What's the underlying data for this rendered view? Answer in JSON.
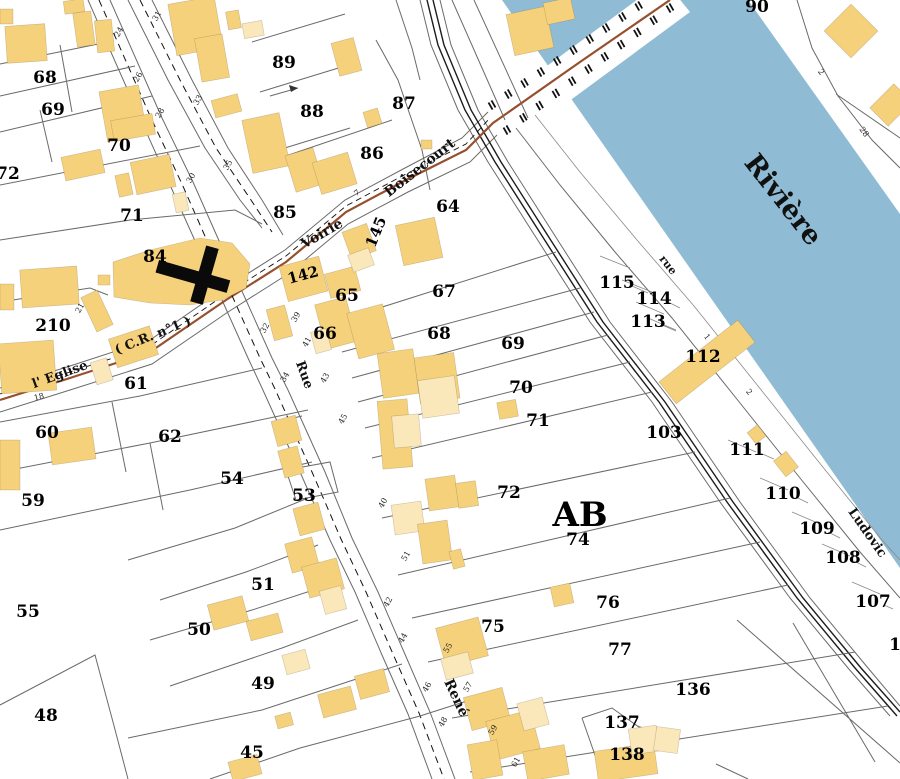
{
  "map": {
    "region_code": "AB",
    "river_name": "Rivière",
    "colors": {
      "river": "#8fbcd4",
      "building": "#f6d17c",
      "building_light": "#fae8bb",
      "route_brown": "#96502d",
      "boundary_gray": "#6a6a6a",
      "road_dark": "#1c1c1c",
      "background": "#ffffff",
      "text": "#000000"
    },
    "parcel_labels": [
      {
        "t": "90",
        "x": 757,
        "y": 7
      },
      {
        "t": "68",
        "x": 45,
        "y": 78
      },
      {
        "t": "69",
        "x": 53,
        "y": 110
      },
      {
        "t": "70",
        "x": 119,
        "y": 146
      },
      {
        "t": "72",
        "x": 8,
        "y": 174
      },
      {
        "t": "71",
        "x": 132,
        "y": 216
      },
      {
        "t": "89",
        "x": 284,
        "y": 63
      },
      {
        "t": "88",
        "x": 312,
        "y": 112
      },
      {
        "t": "87",
        "x": 404,
        "y": 104
      },
      {
        "t": "86",
        "x": 372,
        "y": 154
      },
      {
        "t": "85",
        "x": 285,
        "y": 213
      },
      {
        "t": "64",
        "x": 448,
        "y": 207
      },
      {
        "t": "84",
        "x": 155,
        "y": 257
      },
      {
        "t": "210",
        "x": 53,
        "y": 326
      },
      {
        "t": "61",
        "x": 136,
        "y": 384
      },
      {
        "t": "60",
        "x": 47,
        "y": 433
      },
      {
        "t": "62",
        "x": 170,
        "y": 437
      },
      {
        "t": "54",
        "x": 232,
        "y": 479
      },
      {
        "t": "59",
        "x": 33,
        "y": 501
      },
      {
        "t": "53",
        "x": 304,
        "y": 496
      },
      {
        "t": "55",
        "x": 28,
        "y": 612
      },
      {
        "t": "51",
        "x": 263,
        "y": 585
      },
      {
        "t": "50",
        "x": 199,
        "y": 630
      },
      {
        "t": "49",
        "x": 263,
        "y": 684
      },
      {
        "t": "45",
        "x": 252,
        "y": 753
      },
      {
        "t": "48",
        "x": 46,
        "y": 716
      },
      {
        "t": "65",
        "x": 347,
        "y": 296
      },
      {
        "t": "66",
        "x": 325,
        "y": 334
      },
      {
        "t": "67",
        "x": 444,
        "y": 292
      },
      {
        "t": "68",
        "x": 439,
        "y": 334
      },
      {
        "t": "69",
        "x": 513,
        "y": 344
      },
      {
        "t": "70",
        "x": 521,
        "y": 388
      },
      {
        "t": "71",
        "x": 538,
        "y": 421
      },
      {
        "t": "72",
        "x": 509,
        "y": 493
      },
      {
        "t": "AB",
        "x": 580,
        "y": 515,
        "s": 34
      },
      {
        "t": "74",
        "x": 578,
        "y": 540
      },
      {
        "t": "75",
        "x": 493,
        "y": 627
      },
      {
        "t": "76",
        "x": 608,
        "y": 603
      },
      {
        "t": "77",
        "x": 620,
        "y": 650
      },
      {
        "t": "103",
        "x": 664,
        "y": 433
      },
      {
        "t": "115",
        "x": 617,
        "y": 283
      },
      {
        "t": "114",
        "x": 654,
        "y": 299
      },
      {
        "t": "113",
        "x": 648,
        "y": 322
      },
      {
        "t": "112",
        "x": 703,
        "y": 357
      },
      {
        "t": "111",
        "x": 747,
        "y": 450
      },
      {
        "t": "110",
        "x": 783,
        "y": 494
      },
      {
        "t": "109",
        "x": 817,
        "y": 529
      },
      {
        "t": "108",
        "x": 843,
        "y": 558
      },
      {
        "t": "107",
        "x": 873,
        "y": 602
      },
      {
        "t": "1",
        "x": 895,
        "y": 645
      },
      {
        "t": "136",
        "x": 693,
        "y": 690
      },
      {
        "t": "137",
        "x": 622,
        "y": 723
      },
      {
        "t": "138",
        "x": 627,
        "y": 755
      },
      {
        "t": "142",
        "x": 303,
        "y": 275,
        "s": 15,
        "r": -15
      },
      {
        "t": "145",
        "x": 376,
        "y": 232,
        "s": 15,
        "r": -68
      }
    ],
    "street_labels": [
      {
        "t": "Rivière",
        "x": 783,
        "y": 200,
        "r": 52,
        "s": 27
      },
      {
        "t": "Voirie",
        "x": 322,
        "y": 234,
        "r": -30,
        "s": 14
      },
      {
        "t": "Boisecourt",
        "x": 420,
        "y": 168,
        "r": -38,
        "s": 14
      },
      {
        "t": "l' Eglise",
        "x": 60,
        "y": 375,
        "r": -20,
        "s": 13
      },
      {
        "t": "( C.R. n°1 )",
        "x": 153,
        "y": 336,
        "r": -22,
        "s": 13
      },
      {
        "t": "Rue",
        "x": 304,
        "y": 375,
        "r": 70,
        "s": 13
      },
      {
        "t": "René",
        "x": 456,
        "y": 698,
        "r": 65,
        "s": 14
      },
      {
        "t": "rue",
        "x": 668,
        "y": 265,
        "r": 52,
        "s": 11
      },
      {
        "t": "Ludovic",
        "x": 867,
        "y": 533,
        "r": 55,
        "s": 13
      }
    ],
    "house_numbers": [
      {
        "t": "24",
        "x": 119,
        "y": 32,
        "r": -60
      },
      {
        "t": "26",
        "x": 138,
        "y": 77,
        "r": -60
      },
      {
        "t": "28",
        "x": 160,
        "y": 113,
        "r": -60
      },
      {
        "t": "30",
        "x": 191,
        "y": 178,
        "r": -60
      },
      {
        "t": "31",
        "x": 157,
        "y": 16,
        "r": -60
      },
      {
        "t": "33",
        "x": 198,
        "y": 100,
        "r": -60
      },
      {
        "t": "35",
        "x": 228,
        "y": 165,
        "r": -60
      },
      {
        "t": "32",
        "x": 265,
        "y": 328,
        "r": -60
      },
      {
        "t": "34",
        "x": 285,
        "y": 377,
        "r": -60
      },
      {
        "t": "39",
        "x": 296,
        "y": 317,
        "r": -60
      },
      {
        "t": "41",
        "x": 307,
        "y": 342,
        "r": -60
      },
      {
        "t": "43",
        "x": 325,
        "y": 378,
        "r": -60
      },
      {
        "t": "45",
        "x": 343,
        "y": 419,
        "r": -60
      },
      {
        "t": "40",
        "x": 383,
        "y": 503,
        "r": -60
      },
      {
        "t": "51",
        "x": 406,
        "y": 556,
        "r": -60
      },
      {
        "t": "42",
        "x": 388,
        "y": 602,
        "r": -60
      },
      {
        "t": "44",
        "x": 403,
        "y": 638,
        "r": -60
      },
      {
        "t": "46",
        "x": 427,
        "y": 687,
        "r": -60
      },
      {
        "t": "48",
        "x": 443,
        "y": 722,
        "r": -60
      },
      {
        "t": "55",
        "x": 448,
        "y": 648,
        "r": -60
      },
      {
        "t": "57",
        "x": 468,
        "y": 687,
        "r": -60
      },
      {
        "t": "59",
        "x": 493,
        "y": 730,
        "r": -60
      },
      {
        "t": "61",
        "x": 516,
        "y": 762,
        "r": -60
      },
      {
        "t": "7",
        "x": 357,
        "y": 193,
        "r": -35
      },
      {
        "t": "18",
        "x": 39,
        "y": 397,
        "r": -15
      },
      {
        "t": "21",
        "x": 80,
        "y": 308,
        "r": -60
      },
      {
        "t": "2",
        "x": 821,
        "y": 72,
        "r": 55
      },
      {
        "t": "28",
        "x": 864,
        "y": 132,
        "r": 55
      },
      {
        "t": "1",
        "x": 707,
        "y": 337,
        "r": 52
      },
      {
        "t": "2",
        "x": 749,
        "y": 392,
        "r": 52
      }
    ]
  }
}
